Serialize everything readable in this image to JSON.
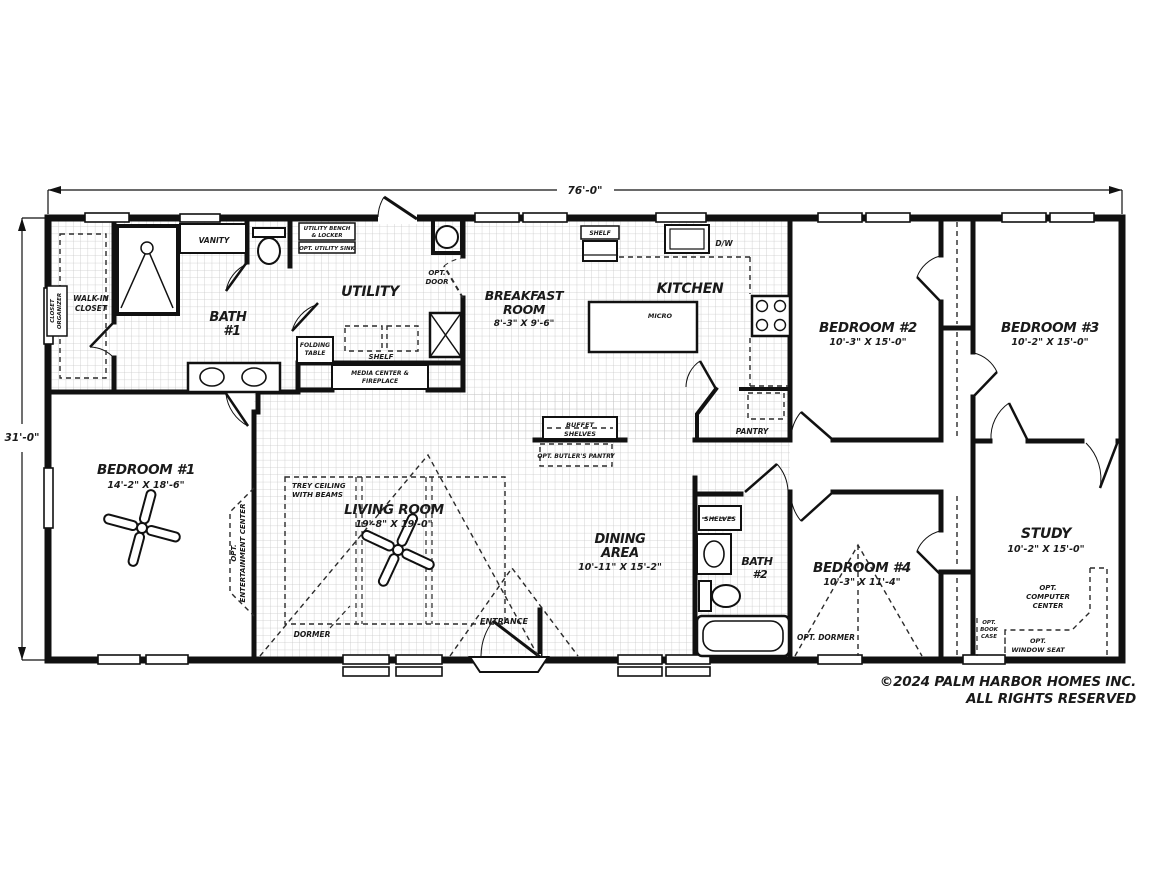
{
  "dimensions": {
    "width": "76'-0\"",
    "height": "31'-0\""
  },
  "rooms": {
    "walk_in_closet": {
      "l1": "WALK-IN",
      "l2": "CLOSET"
    },
    "bath1": {
      "l1": "BATH",
      "l2": "#1"
    },
    "utility": {
      "name": "UTILITY"
    },
    "breakfast": {
      "l1": "BREAKFAST",
      "l2": "ROOM",
      "dims": "8'-3\" X 9'-6\""
    },
    "kitchen": {
      "name": "KITCHEN"
    },
    "bedroom1": {
      "name": "BEDROOM #1",
      "dims": "14'-2\" X 18'-6\""
    },
    "bedroom2": {
      "name": "BEDROOM #2",
      "dims": "10'-3\" X 15'-0\""
    },
    "bedroom3": {
      "name": "BEDROOM #3",
      "dims": "10'-2\" X 15'-0\""
    },
    "bedroom4": {
      "name": "BEDROOM #4",
      "dims": "10'-3\" X 11'-4\""
    },
    "living": {
      "name": "LIVING ROOM",
      "dims": "19'-8\" X 19'-0\""
    },
    "dining": {
      "l1": "DINING",
      "l2": "AREA",
      "dims": "10'-11\" X 15'-2\""
    },
    "bath2": {
      "l1": "BATH",
      "l2": "#2"
    },
    "study": {
      "name": "STUDY",
      "dims": "10'-2\" X 15'-0\""
    }
  },
  "features": {
    "closet_organizer": {
      "l1": "CLOSET",
      "l2": "ORGANIZER"
    },
    "vanity": "VANITY",
    "utility_bench": {
      "l1": "UTILITY BENCH",
      "l2": "& LOCKER"
    },
    "opt_utility_sink": "OPT. UTILITY SINK",
    "opt_door": {
      "l1": "OPT.",
      "l2": "DOOR"
    },
    "folding_table": {
      "l1": "FOLDING",
      "l2": "TABLE"
    },
    "shelf_utility": "SHELF",
    "media_center": {
      "l1": "MEDIA CENTER &",
      "l2": "FIREPLACE"
    },
    "shelf_kitchen": "SHELF",
    "dishwasher": "D/W",
    "microwave": "MICRO",
    "pantry": "PANTRY",
    "buffet": {
      "l1": "BUFFET",
      "l2": "SHELVES"
    },
    "opt_butlers_pantry": "OPT. BUTLER'S PANTRY",
    "trey_ceiling": {
      "l1": "TREY CEILING",
      "l2": "WITH BEAMS"
    },
    "opt_entertainment": {
      "l1": "OPT.",
      "l2": "ENTERTAINMENT CENTER"
    },
    "dormer": "DORMER",
    "entrance": "ENTRANCE",
    "shelves_bath2": "SHELVES",
    "opt_dormer": "OPT. DORMER",
    "opt_computer": {
      "l1": "OPT.",
      "l2": "COMPUTER",
      "l3": "CENTER"
    },
    "opt_bookcase": {
      "l1": "OPT.",
      "l2": "BOOK",
      "l3": "CASE"
    },
    "opt_window_seat": {
      "l1": "OPT.",
      "l2": "WINDOW SEAT"
    }
  },
  "footer": {
    "copyright": "©2024 PALM HARBOR HOMES INC.",
    "rights": "ALL RIGHTS RESERVED"
  },
  "colors": {
    "wall": "#111111",
    "grid": "#c9c9c9",
    "text": "#1a1a1a"
  }
}
